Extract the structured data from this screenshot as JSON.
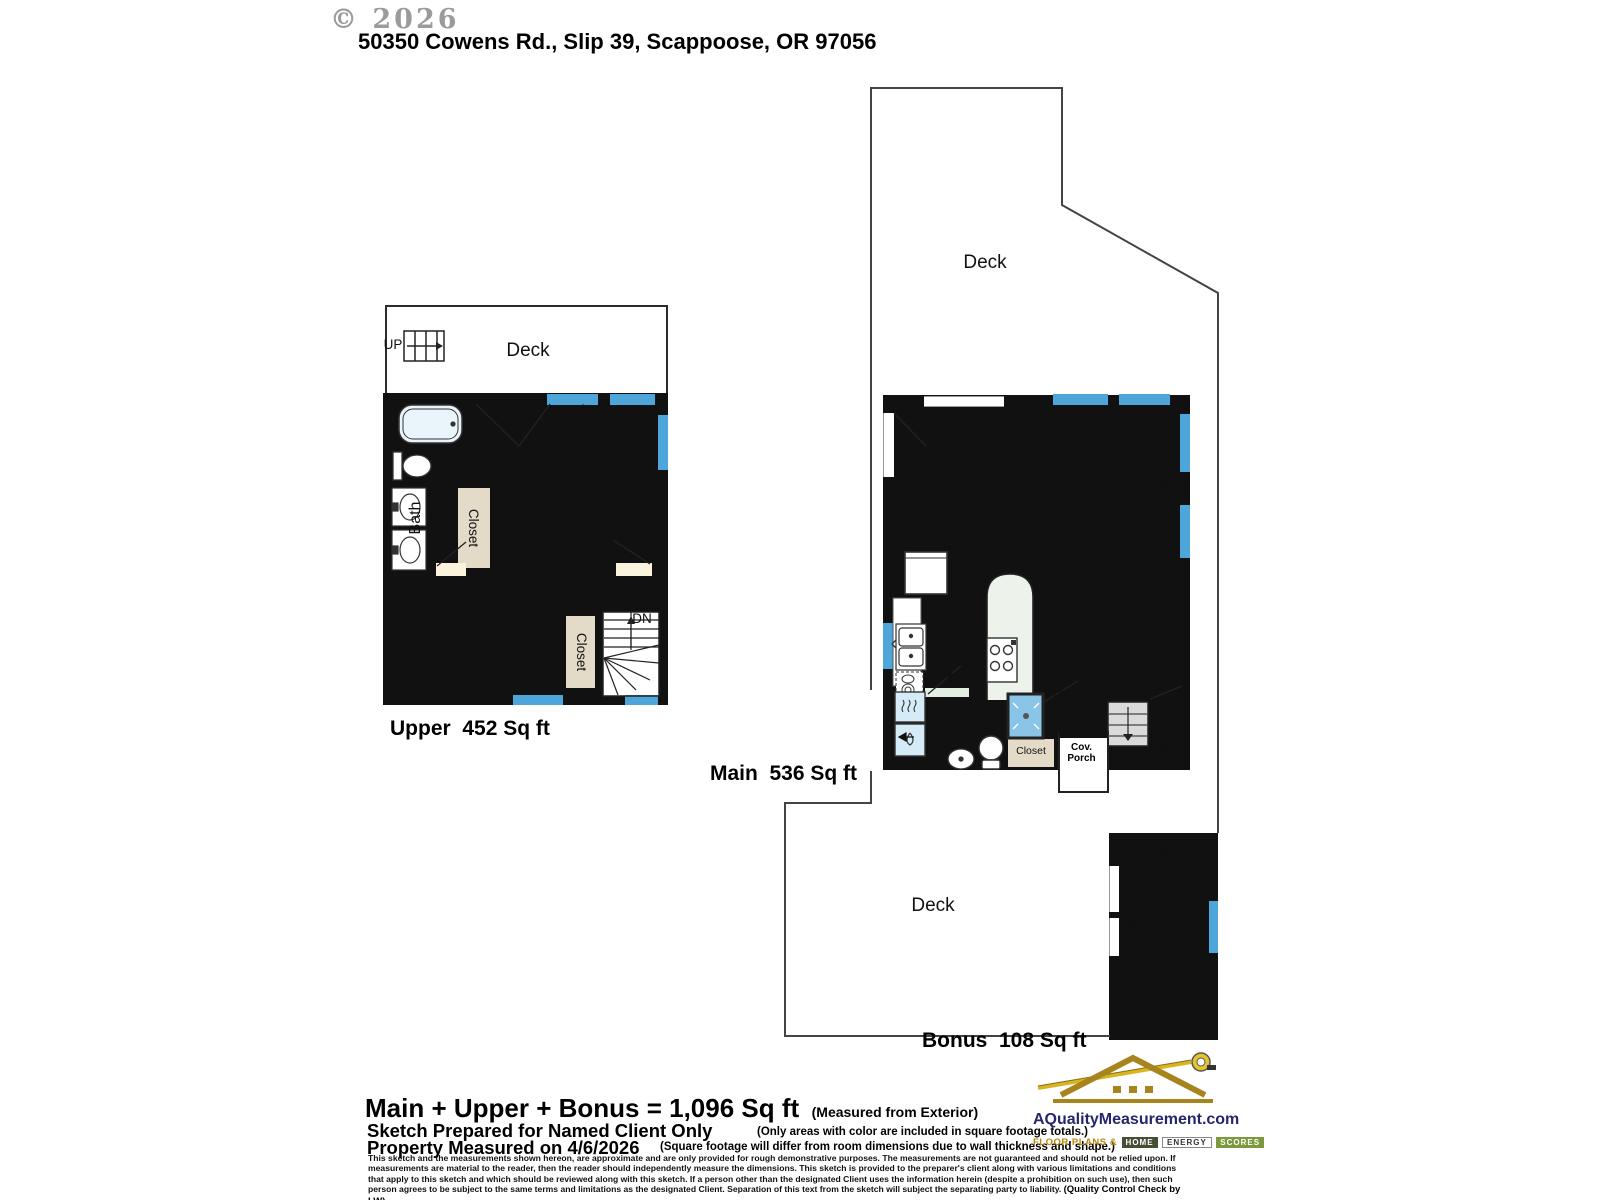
{
  "watermark": "© 2026",
  "title": "50350 Cowens Rd., Slip 39, Scappoose, OR 97056",
  "upper": {
    "deck": "Deck",
    "up": "UP",
    "dn": "DN",
    "bath_name": "Bath",
    "bath_dims": "5'11\" x 11'5\"",
    "closet_a": "Closet",
    "closet_b": "Closet",
    "primary_name": "Primary Bedroom",
    "primary_dims": "13' x 11'7\"",
    "bedroom_name": "Bedroom",
    "bedroom_dims": "14'1\" x 9'4\"",
    "area": "Upper  452 Sq ft"
  },
  "main": {
    "deck": "Deck",
    "living_name": "Living",
    "living_dims": "19'3\" x 10'6\"",
    "kitchen_name": "Kitchen",
    "kitchen_dims": "10'7\" x 13'3\"",
    "dining_name": "Dining",
    "dining_dims": "10'7\" x 12'4\"",
    "bath_name": "Bath",
    "bath_dims": "10'2\" x 5'",
    "laundry": "Laundry",
    "foyer": "Foyer",
    "up": "UP",
    "storage": "Storage",
    "closet": "Closet",
    "cov_porch": "Cov. Porch",
    "area": "Main  536 Sq ft"
  },
  "bonus": {
    "deck": "Deck",
    "name": "Bonus",
    "dims": "6'6\" x 13'5\"",
    "area": "Bonus  108 Sq ft"
  },
  "footer": {
    "total": "Main + Upper + Bonus = 1,096 Sq ft",
    "measured_from": "(Measured from Exterior)",
    "prepared": "Sketch Prepared for Named Client Only",
    "measured_on": "Property Measured on 4/6/2026",
    "note1": "(Only areas with color are included in square footage totals.)",
    "note2": "(Square footage will differ from room dimensions due to wall thickness and shape.)",
    "disclaimer": "This sketch and the measurements shown hereon, are approximate and are only provided for rough demonstrative purposes.  The measurements are not guaranteed and should not be relied upon.  If measurements are material to the reader, then the reader should independently measure the dimensions.  This sketch is provided to the preparer's client along with various limitations and conditions that apply to this sketch and which should be reviewed along with this sketch.  If a person other than the designated Client uses the information herein (despite a prohibition on such use), then such person agrees to be subject to the same terms and limitations as the designated Client.  Separation of this text from the sketch will subject the separating party to liability.",
    "qc": "(Quality Control Check by LW)"
  },
  "logo": {
    "domain": "AQualityMeasurement.com",
    "tagline_prefix": "FLOOR PLANS &",
    "w1": "HOME",
    "w2": "ENERGY",
    "w3": "SCORES"
  },
  "colors": {
    "room_cream": "#FBF3DB",
    "kitchen_green": "#E3EEE3",
    "dining_tan": "#E4DAC8",
    "bath_blue": "#C2E1F5",
    "window_blue": "#4EA5D9",
    "wall_black": "#111111",
    "logo_gold": "#A8841F",
    "logo_navy": "#26266B"
  }
}
